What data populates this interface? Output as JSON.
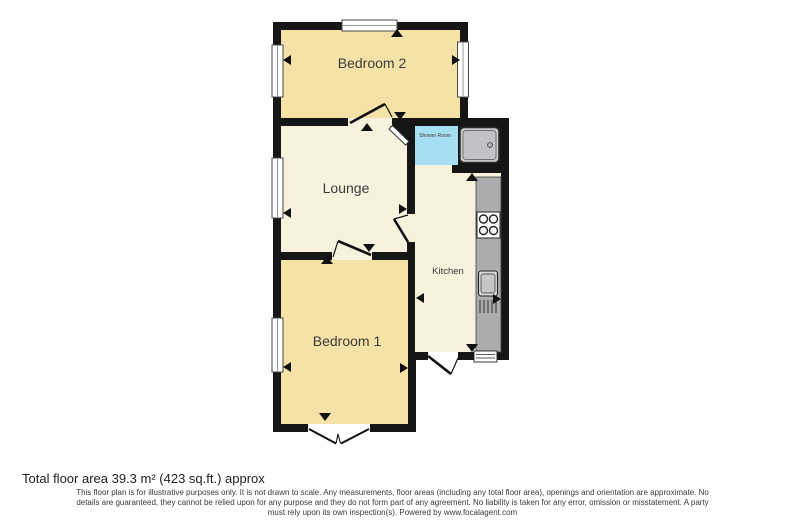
{
  "floorplan": {
    "rooms": [
      {
        "id": "bedroom2",
        "label": "Bedroom 2"
      },
      {
        "id": "lounge",
        "label": "Lounge"
      },
      {
        "id": "shower_room",
        "label": "Shower Room"
      },
      {
        "id": "kitchen",
        "label": "Kitchen"
      },
      {
        "id": "bedroom1",
        "label": "Bedroom 1"
      }
    ],
    "fixtures": [
      "shower-tray",
      "hob",
      "sink"
    ],
    "colors": {
      "wall": "#161616",
      "bedroom_fill": "#f5e2a7",
      "living_fill": "#f7f2dd",
      "shower_fill": "#a7dff2",
      "counter": "#acacac",
      "tray": "#c9c9cc",
      "window_line": "#999999",
      "outside": "#ffffff"
    }
  },
  "footer": {
    "area_text": "Total floor area 39.3 m² (423 sq.ft.) approx",
    "disclaimer_lines": [
      "This floor plan is for illustrative purposes only. It is not drawn to scale. Any measurements, floor areas (including any total floor area), openings and orientation are approximate. No",
      "details are guaranteed, they cannot be relied upon for any purpose and they do not form part of any agreement. No liability is taken for any error, omission or misstatement. A party",
      "must rely upon its own inspection(s). Powered by www.focalagent.com"
    ]
  }
}
